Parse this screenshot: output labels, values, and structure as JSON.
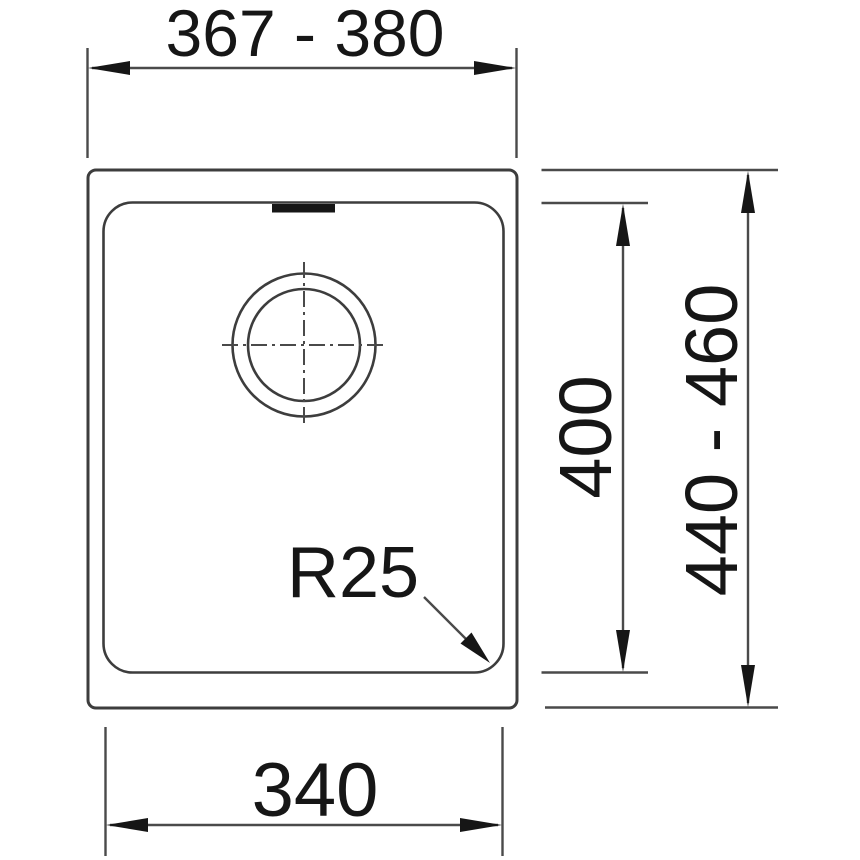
{
  "drawing": {
    "labels": {
      "cutout_width": "367 - 380",
      "bowl_depth": "400",
      "cutout_depth": "440 - 460",
      "bowl_width": "340",
      "corner_radius": "R25"
    },
    "colors": {
      "background": "#ffffff",
      "outline": "#3d3d3d",
      "line": "#4a4a4a",
      "ink": "#161616"
    }
  }
}
